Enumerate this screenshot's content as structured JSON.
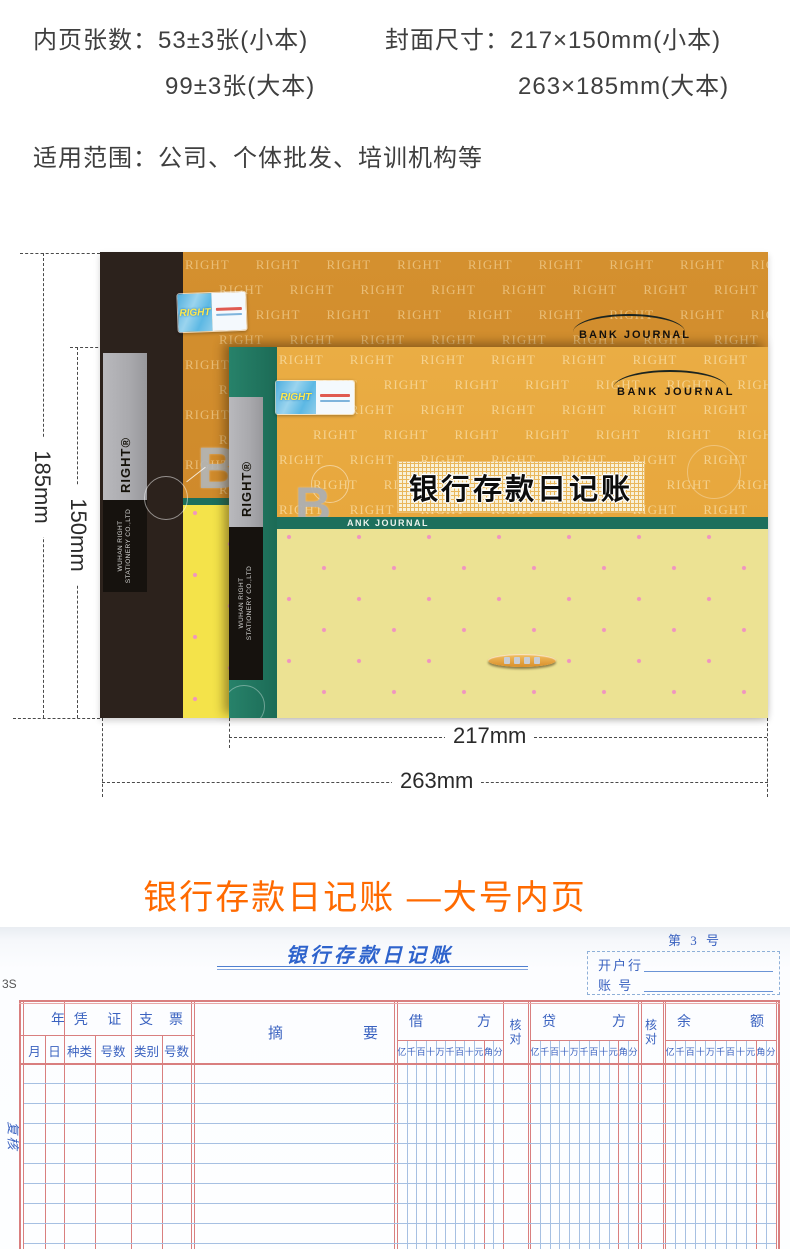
{
  "specs": {
    "pages_label": "内页张数：",
    "pages_small": "53±3张(小本)",
    "pages_large": "99±3张(大本)",
    "cover_label": "封面尺寸：",
    "cover_small": "217×150mm(小本)",
    "cover_large": "263×185mm(大本)",
    "usage_label": "适用范围：",
    "usage_value": "公司、个体批发、培训机构等"
  },
  "product": {
    "pattern_word": "RIGHT",
    "brand_logo": "RIGHT®",
    "company_line1": "WUHAN RIGHT",
    "company_line2": "STATIONERY CO.,LTD",
    "bank_journal": "BANK JOURNAL",
    "big_letter": "B",
    "ank_journal": "ANK JOURNAL",
    "cover_title": "银行存款日记账",
    "sticker_brand": "RIGHT",
    "dimensions": {
      "height_large": "185mm",
      "height_small": "150mm",
      "width_small": "217mm",
      "width_large": "263mm"
    }
  },
  "section": {
    "title": "银行存款日记账 —大号内页"
  },
  "ledger": {
    "page_no": "第 3 号",
    "title": "银行存款日记账",
    "bank_label": "开户行",
    "account_label": "账 号",
    "margin_code": "3S",
    "review_label": "复核",
    "header": {
      "year": "年",
      "month": "月",
      "day": "日",
      "voucher": "凭证",
      "voucher_type": "种类",
      "voucher_no": "号数",
      "cheque": "支票",
      "cheque_type": "类别",
      "cheque_no": "号数",
      "summary": "摘要",
      "debit": "借方",
      "credit": "贷方",
      "balance": "余额",
      "check": "核对",
      "digits": "亿千百十万千百十元角分"
    }
  },
  "colors": {
    "accent_orange": "#ff6a00",
    "spec_text": "#3f3f3f",
    "dim_text": "#2a2a2a",
    "back_cover": "#cf8a2b",
    "front_cover": "#e7a73d",
    "teal": "#1d6f5c",
    "green_band": "#27826a",
    "bright_yellow": "#f4e34a",
    "pale_yellow": "#ece293",
    "dot_pink": "#f095c0",
    "spine_brown": "#2c221c",
    "stripe_gray": "#a9a9ad",
    "stripe_black": "#16120e",
    "band_bg": "#f8f1d9",
    "band_grid": "#e9b75c",
    "ledger_red": "#d97f7f",
    "ledger_blue": "#a6c0e2",
    "ledger_text": "#3a62c0"
  }
}
